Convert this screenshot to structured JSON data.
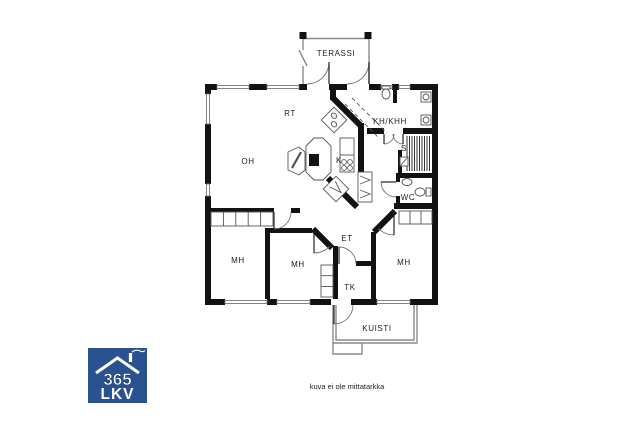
{
  "rooms": {
    "terassi": "TERASSI",
    "rt": "RT",
    "oh": "OH",
    "k": "K",
    "kh_khh": "KH/KHH",
    "s": "S",
    "wc": "WC",
    "et": "ET",
    "mh_left": "MH",
    "mh_mid": "MH",
    "mh_right": "MH",
    "tk": "TK",
    "kuisti": "KUISTI"
  },
  "footer": {
    "disclaimer": "kuva ei ole mittatarkka"
  },
  "logo": {
    "number": "365",
    "letters": "LKV",
    "bg_color": "#2b5290",
    "icon": "house-roof-icon"
  },
  "colors": {
    "wall": "#121212",
    "fixture_line": "#555555",
    "label": "#222222"
  }
}
